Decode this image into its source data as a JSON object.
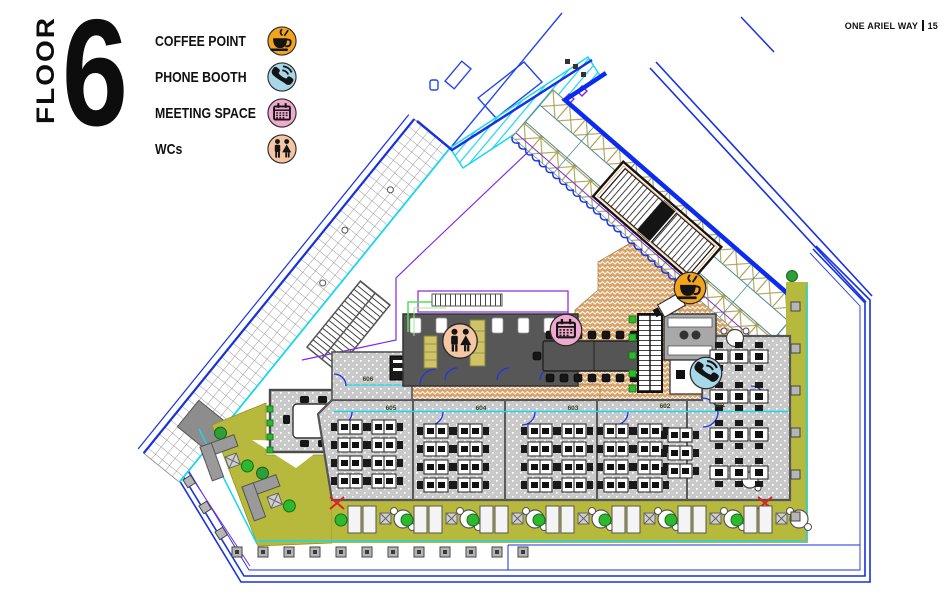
{
  "header": {
    "floor_label": "FLOOR",
    "floor_number": "6",
    "project_name": "ONE ARIEL WAY",
    "page_number": "15"
  },
  "legend": {
    "items": [
      {
        "label": "COFFEE POINT",
        "icon": "coffee-icon",
        "color": "#F2A41E"
      },
      {
        "label": "PHONE BOOTH",
        "icon": "phone-icon",
        "color": "#A7D7E9"
      },
      {
        "label": "MEETING SPACE",
        "icon": "meeting-icon",
        "color": "#F0A9CF"
      },
      {
        "label": "WCs",
        "icon": "wc-icon",
        "color": "#F4C6A3"
      }
    ]
  },
  "plan": {
    "rooms": [
      {
        "number": "606"
      },
      {
        "number": "605"
      },
      {
        "number": "604"
      },
      {
        "number": "603"
      },
      {
        "number": "602"
      },
      {
        "number": "601"
      }
    ],
    "markers": [
      {
        "type": "coffee-point",
        "icon": "coffee-icon"
      },
      {
        "type": "phone-booth",
        "icon": "phone-icon"
      },
      {
        "type": "meeting-space",
        "icon": "meeting-icon"
      },
      {
        "type": "wcs",
        "icon": "wc-icon"
      }
    ],
    "colors": {
      "terrace_olive": "#b6b93c",
      "breakout_tan": "#dba267",
      "carpet_gray": "#c9c9c9",
      "boundary_blue": "#1631e0",
      "accent_cyan": "#19d7ee",
      "accent_purple": "#7d2ae8"
    }
  }
}
